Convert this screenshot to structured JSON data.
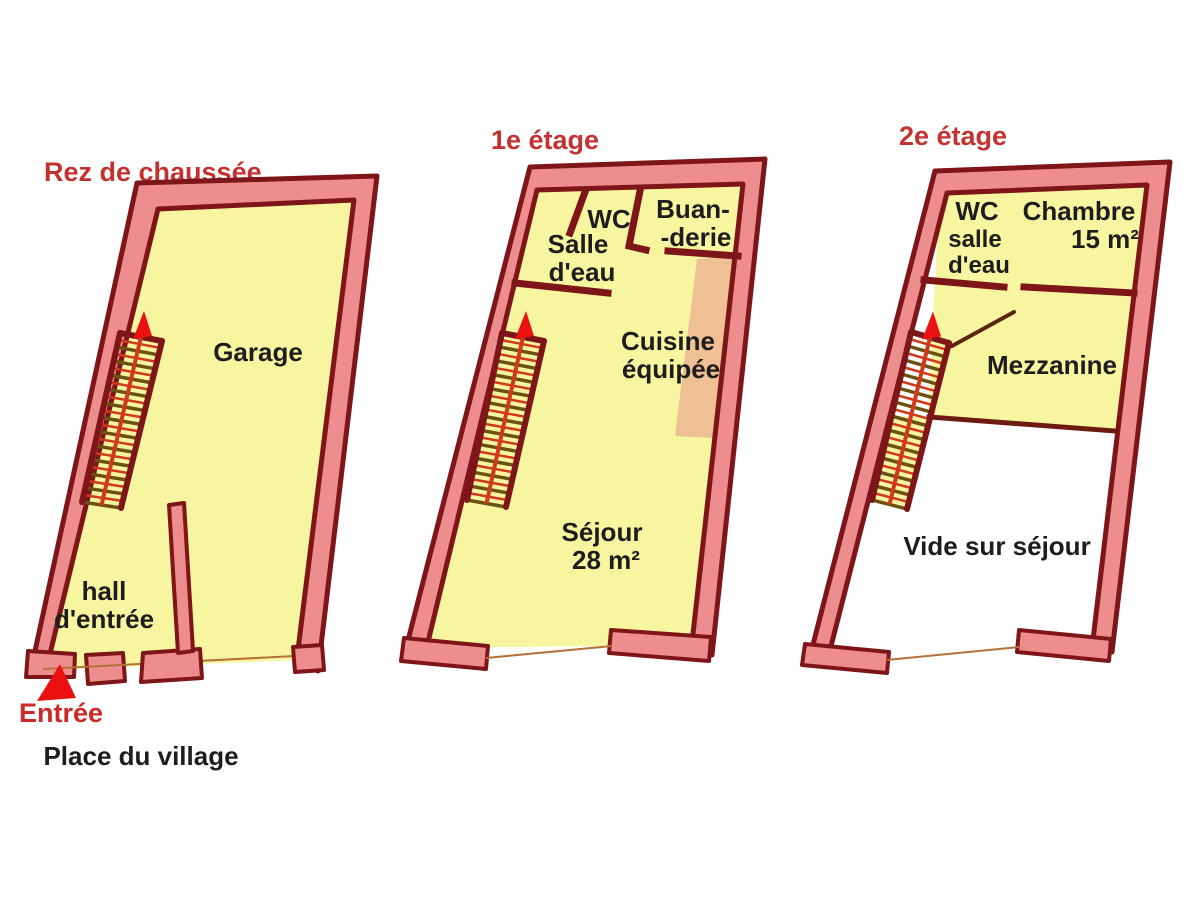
{
  "colors": {
    "wall_fill": "#ee8d8d",
    "wall_outline": "#7d1519",
    "floor_fill": "#f8f5a0",
    "kitchen_counter_fill": "#eec093",
    "title_red": "#c23230",
    "label_black": "#1d1d1d",
    "stair_stringer_red": "#d2391b",
    "stair_rung_brown": "#6b5212",
    "arrow_red": "#ec1111"
  },
  "floors": [
    {
      "id": "rez-de-chaussee",
      "title": "Rez de chaussée",
      "labels": {
        "garage": "Garage",
        "hall_line1": "hall",
        "hall_line2": "d'entrée"
      },
      "entrance": "Entrée",
      "street": "Place du village"
    },
    {
      "id": "premier-etage",
      "title": "1e étage",
      "labels": {
        "salle_line1": "Salle",
        "salle_line2": "d'eau",
        "wc": "WC",
        "buanderie_line1": "Buan-",
        "buanderie_line2": "-derie",
        "cuisine_line1": "Cuisine",
        "cuisine_line2": "équipée",
        "sejour_line1": "Séjour",
        "sejour_line2": "28 m²"
      }
    },
    {
      "id": "deuxieme-etage",
      "title": "2e étage",
      "labels": {
        "wc": "WC",
        "salle_line1": "salle",
        "salle_line2": "d'eau",
        "chambre_line1": "Chambre",
        "chambre_line2": "15 m²",
        "mezzanine": "Mezzanine",
        "vide": "Vide sur séjour"
      }
    }
  ]
}
